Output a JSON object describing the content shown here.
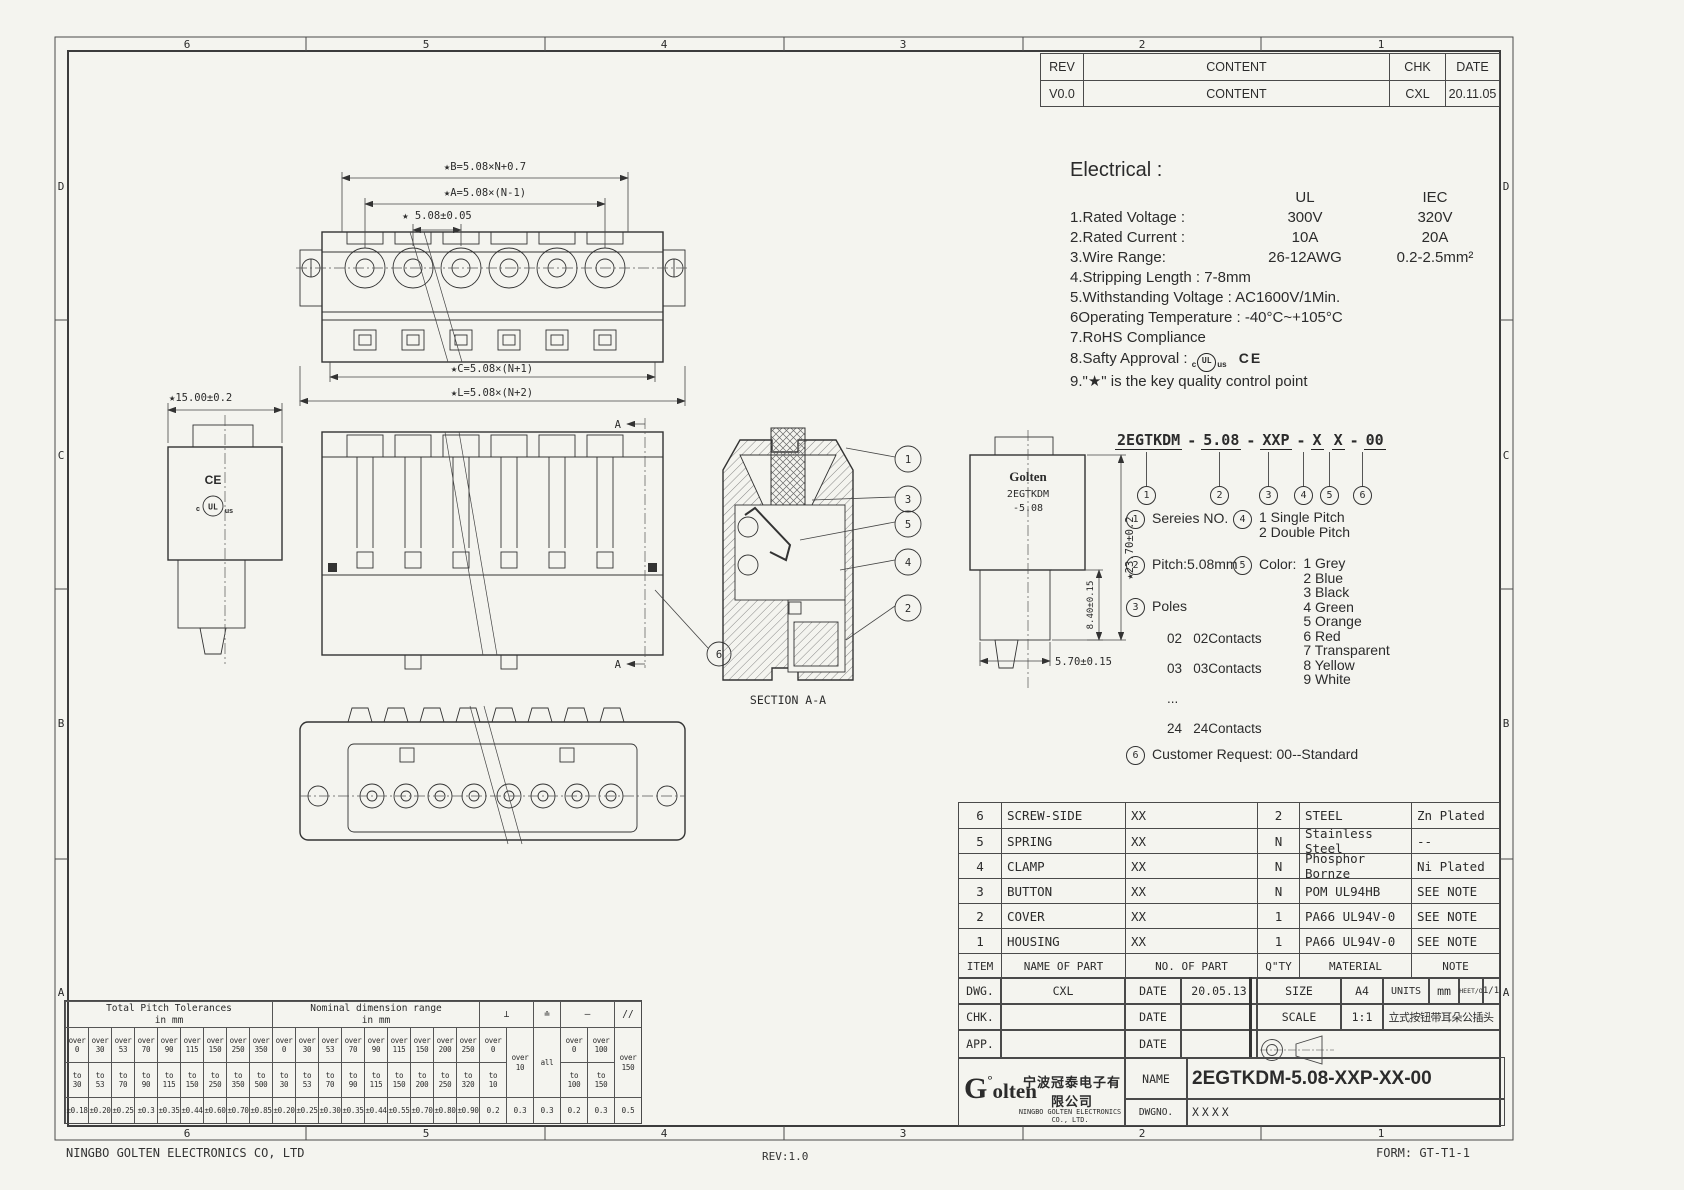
{
  "frame": {
    "top_zones": [
      "6",
      "5",
      "4",
      "3",
      "2",
      "1"
    ],
    "bottom_zones": [
      "6",
      "5",
      "4",
      "3",
      "2",
      "1"
    ],
    "left_zones": [
      "D",
      "C",
      "B",
      "A"
    ],
    "right_zones": [
      "D",
      "C",
      "B",
      "A"
    ],
    "footer_left": "NINGBO GOLTEN ELECTRONICS CO, LTD",
    "footer_center": "REV:1.0",
    "footer_right": "FORM: GT-T1-1"
  },
  "revision": {
    "headers": [
      "REV",
      "CONTENT",
      "CHK",
      "DATE"
    ],
    "row": [
      "V0.0",
      "CONTENT",
      "CXL",
      "20.11.05"
    ]
  },
  "electrical": {
    "title": "Electrical :",
    "col1": "UL",
    "col2": "IEC",
    "rows": [
      {
        "label": "1.Rated Voltage :",
        "ul": "300V",
        "iec": "320V"
      },
      {
        "label": "2.Rated Current :",
        "ul": "10A",
        "iec": "20A"
      },
      {
        "label": "3.Wire Range:",
        "ul": "26-12AWG",
        "iec": "0.2-2.5mm²"
      }
    ],
    "line4": "4.Stripping Length : 7-8mm",
    "line5": "5.Withstanding Voltage : AC1600V/1Min.",
    "line6": "6Operating Temperature : -40°C~+105°C",
    "line7": "7.RoHS Compliance",
    "line8": "8.Safty Approval :",
    "line9": "9.\"★\" is the key quality control point"
  },
  "marks": {
    "c": "c",
    "ul": "UL",
    "us": "us",
    "ce": "CE"
  },
  "part_code": {
    "seg1": "2EGTKDM",
    "seg2": "5.08",
    "seg3": "XXP",
    "seg4": "X",
    "seg5": "X",
    "seg6": "00",
    "dash": "-",
    "n1": "1",
    "n2": "2",
    "n3": "3",
    "n4": "4",
    "n5": "5",
    "n6": "6",
    "legend1": "Sereies NO.",
    "legend2": "Pitch:5.08mm",
    "legend3": "Poles",
    "poles": [
      "02   02Contacts",
      "03   03Contacts",
      "...",
      "24   24Contacts"
    ],
    "legend4a": "1  Single Pitch",
    "legend4b": "2  Double Pitch",
    "legend5": "Color:",
    "colors": [
      "1 Grey",
      "2 Blue",
      "3 Black",
      "4 Green",
      "5 Orange",
      "6 Red",
      "7 Transparent",
      "8 Yellow",
      "9 White"
    ],
    "legend6": "Customer Request: 00--Standard"
  },
  "bom": {
    "rows": [
      [
        "6",
        "SCREW-SIDE",
        "XX",
        "2",
        "STEEL",
        "Zn Plated"
      ],
      [
        "5",
        "SPRING",
        "XX",
        "N",
        "Stainless Steel",
        "--"
      ],
      [
        "4",
        "CLAMP",
        "XX",
        "N",
        "Phosphor Bornze",
        "Ni Plated"
      ],
      [
        "3",
        "BUTTON",
        "XX",
        "N",
        "POM UL94HB",
        "SEE NOTE"
      ],
      [
        "2",
        "COVER",
        "XX",
        "1",
        "PA66 UL94V-0",
        "SEE NOTE"
      ],
      [
        "1",
        "HOUSING",
        "XX",
        "1",
        "PA66 UL94V-0",
        "SEE NOTE"
      ]
    ],
    "header": [
      "ITEM",
      "NAME OF PART",
      "NO. OF PART",
      "Q\"TY",
      "MATERIAL",
      "NOTE"
    ]
  },
  "title_block": {
    "dwg": "DWG.",
    "dwg_val": "CXL",
    "date": "DATE",
    "date_val": "20.05.13",
    "chk": "CHK.",
    "app": "APP.",
    "size": "SIZE",
    "size_val": "A4",
    "units": "UNITS",
    "units_val": "mm",
    "sheet": "SHEET/OF",
    "sheet_val": "1/1",
    "scale": "SCALE",
    "scale_val": "1:1",
    "product_cn": "立式按钮带耳朵公插头",
    "name": "NAME",
    "name_val": "2EGTKDM-5.08-XXP-XX-00",
    "dwgno": "DWGNO.",
    "dwgno_val": "XXXX",
    "logo_g": "G",
    "logo_deg": "°",
    "logo_rest": "olten",
    "company_cn": "宁波冠泰电子有限公司",
    "company_en": "NINGBO GOLTEN ELECTRONICS CO., LTD."
  },
  "tol": {
    "g1": "Total Pitch Tolerances\nin mm",
    "g2": "Nominal dimension range\nin mm",
    "s1": "⊥",
    "s2": "≐",
    "s3": "—",
    "s4": "//",
    "cols": [
      {
        "o": "over\n0",
        "t": "to\n30",
        "v": "±0.18"
      },
      {
        "o": "over\n30",
        "t": "to\n53",
        "v": "±0.20"
      },
      {
        "o": "over\n53",
        "t": "to\n70",
        "v": "±0.25"
      },
      {
        "o": "over\n70",
        "t": "to\n90",
        "v": "±0.3"
      },
      {
        "o": "over\n90",
        "t": "to\n115",
        "v": "±0.35"
      },
      {
        "o": "over\n115",
        "t": "to\n150",
        "v": "±0.44"
      },
      {
        "o": "over\n150",
        "t": "to\n250",
        "v": "±0.60"
      },
      {
        "o": "over\n250",
        "t": "to\n350",
        "v": "±0.70"
      },
      {
        "o": "over\n350",
        "t": "to\n500",
        "v": "±0.85"
      },
      {
        "o": "over\n0",
        "t": "to\n30",
        "v": "±0.20"
      },
      {
        "o": "over\n30",
        "t": "to\n53",
        "v": "±0.25"
      },
      {
        "o": "over\n53",
        "t": "to\n70",
        "v": "±0.30"
      },
      {
        "o": "over\n70",
        "t": "to\n90",
        "v": "±0.35"
      },
      {
        "o": "over\n90",
        "t": "to\n115",
        "v": "±0.44"
      },
      {
        "o": "over\n115",
        "t": "to\n150",
        "v": "±0.55"
      },
      {
        "o": "over\n150",
        "t": "to\n200",
        "v": "±0.70"
      },
      {
        "o": "over\n200",
        "t": "to\n250",
        "v": "±0.80"
      },
      {
        "o": "over\n250",
        "t": "to\n320",
        "v": "±0.90"
      },
      {
        "o": "over\n0",
        "t": "to\n10",
        "v": "0.2"
      },
      {
        "f": "over\n10",
        "v": "0.3"
      },
      {
        "f": "all",
        "v": "0.3"
      },
      {
        "o": "over\n0",
        "t": "to\n100",
        "v": "0.2"
      },
      {
        "o": "over\n100",
        "t": "to\n150",
        "v": "0.3"
      },
      {
        "f": "over\n150",
        "v": "0.5"
      }
    ]
  },
  "views": {
    "b1": "1",
    "b2": "2",
    "b3": "3",
    "b4": "4",
    "b5": "5",
    "b6": "6",
    "section": "SECTION A-A",
    "a": "A",
    "dim_b": "★B=5.08×N+0.7",
    "dim_a": "★A=5.08×(N-1)",
    "dim_p": "★ 5.08±0.05",
    "dim_c": "★C=5.08×(N+1)",
    "dim_l": "★L=5.08×(N+2)",
    "dim_w": "★15.00±0.2",
    "dim_h": "★23.70±0.2",
    "dim_h2": "8.40±0.15",
    "dim_d": "5.70±0.15",
    "logo": "Golten",
    "model": "2EGTKDM",
    "pitch": "-5.08",
    "ce": "CE",
    "ul": "UL",
    "ul_c": "c",
    "ul_us": "us"
  }
}
